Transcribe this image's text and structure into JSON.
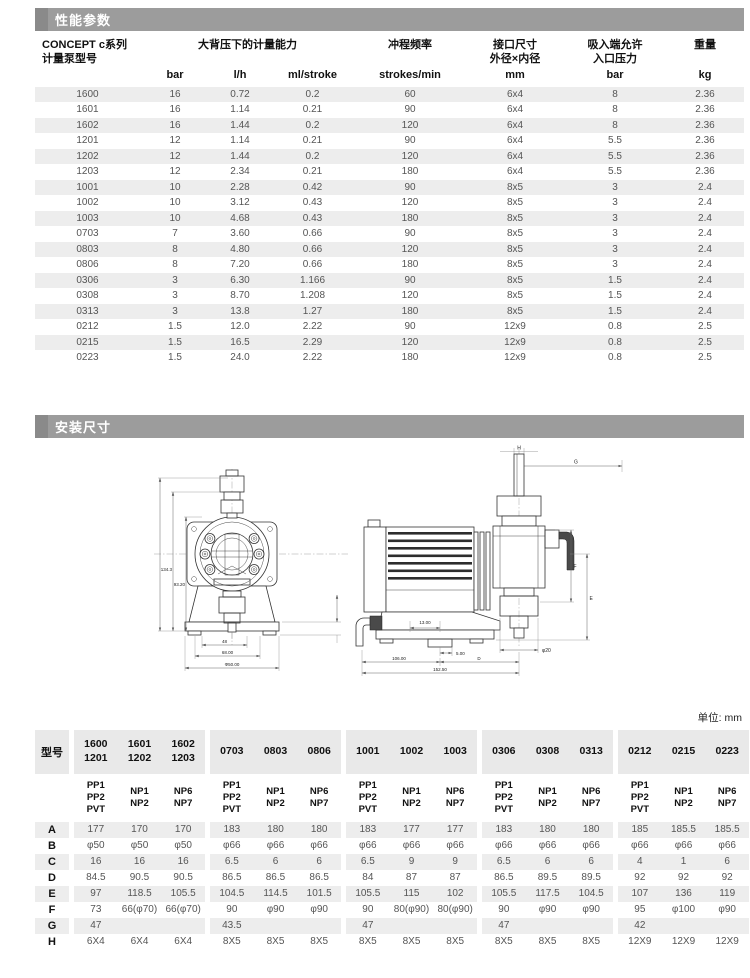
{
  "colors": {
    "section_bar": "#9c9c9c",
    "section_bar_chip": "#8a8a8a",
    "row_stripe": "#ededed",
    "header_text": "#111111",
    "body_text": "#555555"
  },
  "sections": {
    "performance": "性能参数",
    "installation": "安装尺寸"
  },
  "perf_table": {
    "group_headers": {
      "model": "CONCEPT c系列\n计量泵型号",
      "capacity": "大背压下的计量能力",
      "stroke_freq": "冲程频率",
      "connection": "接口尺寸\n外径×内径",
      "suction": "吸入端允许\n入口压力",
      "weight": "重量"
    },
    "units": [
      "bar",
      "l/h",
      "ml/stroke",
      "strokes/min",
      "mm",
      "bar",
      "kg"
    ],
    "rows": [
      [
        "1600",
        "16",
        "0.72",
        "0.2",
        "60",
        "6x4",
        "8",
        "2.36"
      ],
      [
        "1601",
        "16",
        "1.14",
        "0.21",
        "90",
        "6x4",
        "8",
        "2.36"
      ],
      [
        "1602",
        "16",
        "1.44",
        "0.2",
        "120",
        "6x4",
        "8",
        "2.36"
      ],
      [
        "1201",
        "12",
        "1.14",
        "0.21",
        "90",
        "6x4",
        "5.5",
        "2.36"
      ],
      [
        "1202",
        "12",
        "1.44",
        "0.2",
        "120",
        "6x4",
        "5.5",
        "2.36"
      ],
      [
        "1203",
        "12",
        "2.34",
        "0.21",
        "180",
        "6x4",
        "5.5",
        "2.36"
      ],
      [
        "1001",
        "10",
        "2.28",
        "0.42",
        "90",
        "8x5",
        "3",
        "2.4"
      ],
      [
        "1002",
        "10",
        "3.12",
        "0.43",
        "120",
        "8x5",
        "3",
        "2.4"
      ],
      [
        "1003",
        "10",
        "4.68",
        "0.43",
        "180",
        "8x5",
        "3",
        "2.4"
      ],
      [
        "0703",
        "7",
        "3.60",
        "0.66",
        "90",
        "8x5",
        "3",
        "2.4"
      ],
      [
        "0803",
        "8",
        "4.80",
        "0.66",
        "120",
        "8x5",
        "3",
        "2.4"
      ],
      [
        "0806",
        "8",
        "7.20",
        "0.66",
        "180",
        "8x5",
        "3",
        "2.4"
      ],
      [
        "0306",
        "3",
        "6.30",
        "1.166",
        "90",
        "8x5",
        "1.5",
        "2.4"
      ],
      [
        "0308",
        "3",
        "8.70",
        "1.208",
        "120",
        "8x5",
        "1.5",
        "2.4"
      ],
      [
        "0313",
        "3",
        "13.8",
        "1.27",
        "180",
        "8x5",
        "1.5",
        "2.4"
      ],
      [
        "0212",
        "1.5",
        "12.0",
        "2.22",
        "90",
        "12x9",
        "0.8",
        "2.5"
      ],
      [
        "0215",
        "1.5",
        "16.5",
        "2.29",
        "120",
        "12x9",
        "0.8",
        "2.5"
      ],
      [
        "0223",
        "1.5",
        "24.0",
        "2.22",
        "180",
        "12x9",
        "0.8",
        "2.5"
      ]
    ]
  },
  "drawings": {
    "front_dims": {
      "height_outer": "134.3",
      "height_inner": "93.20",
      "width_small": "48",
      "width_mid": "68.00",
      "width_full": "Φ50.00"
    },
    "side_dims": {
      "h": "H",
      "g": "G",
      "f": "F",
      "e": "E",
      "offset": "13.00",
      "foot": "5.00",
      "left_len": "106.00",
      "right_len": "D",
      "total_len": "152.50",
      "port": "φ20"
    }
  },
  "unit_note": "单位: mm",
  "dims_table": {
    "corner": "型号",
    "model_groups": [
      [
        "1600\n1201",
        "1601\n1202",
        "1602\n1203"
      ],
      [
        "0703",
        "0803",
        "0806"
      ],
      [
        "1001",
        "1002",
        "1003"
      ],
      [
        "0306",
        "0308",
        "0313"
      ],
      [
        "0212",
        "0215",
        "0223"
      ]
    ],
    "materials": [
      "PP1\nPP2\nPVT",
      "NP1\nNP2",
      "NP6\nNP7"
    ],
    "rows": [
      {
        "label": "A",
        "groups": [
          [
            "177",
            "170",
            "170"
          ],
          [
            "183",
            "180",
            "180"
          ],
          [
            "183",
            "177",
            "177"
          ],
          [
            "183",
            "180",
            "180"
          ],
          [
            "185",
            "185.5",
            "185.5"
          ]
        ]
      },
      {
        "label": "B",
        "groups": [
          [
            "φ50",
            "φ50",
            "φ50"
          ],
          [
            "φ66",
            "φ66",
            "φ66"
          ],
          [
            "φ66",
            "φ66",
            "φ66"
          ],
          [
            "φ66",
            "φ66",
            "φ66"
          ],
          [
            "φ66",
            "φ66",
            "φ66"
          ]
        ]
      },
      {
        "label": "C",
        "groups": [
          [
            "16",
            "16",
            "16"
          ],
          [
            "6.5",
            "6",
            "6"
          ],
          [
            "6.5",
            "9",
            "9"
          ],
          [
            "6.5",
            "6",
            "6"
          ],
          [
            "4",
            "1",
            "6"
          ]
        ]
      },
      {
        "label": "D",
        "groups": [
          [
            "84.5",
            "90.5",
            "90.5"
          ],
          [
            "86.5",
            "86.5",
            "86.5"
          ],
          [
            "84",
            "87",
            "87"
          ],
          [
            "86.5",
            "89.5",
            "89.5"
          ],
          [
            "92",
            "92",
            "92"
          ]
        ]
      },
      {
        "label": "E",
        "groups": [
          [
            "97",
            "118.5",
            "105.5"
          ],
          [
            "104.5",
            "114.5",
            "101.5"
          ],
          [
            "105.5",
            "115",
            "102"
          ],
          [
            "105.5",
            "117.5",
            "104.5"
          ],
          [
            "107",
            "136",
            "119"
          ]
        ]
      },
      {
        "label": "F",
        "groups": [
          [
            "73",
            "66(φ70)",
            "66(φ70)"
          ],
          [
            "90",
            "φ90",
            "φ90"
          ],
          [
            "90",
            "80(φ90)",
            "80(φ90)"
          ],
          [
            "90",
            "φ90",
            "φ90"
          ],
          [
            "95",
            "φ100",
            "φ90"
          ]
        ]
      },
      {
        "label": "G",
        "groups": [
          [
            "47",
            "",
            ""
          ],
          [
            "43.5",
            "",
            ""
          ],
          [
            "47",
            "",
            ""
          ],
          [
            "47",
            "",
            ""
          ],
          [
            "42",
            "",
            ""
          ]
        ]
      },
      {
        "label": "H",
        "groups": [
          [
            "6X4",
            "6X4",
            "6X4"
          ],
          [
            "8X5",
            "8X5",
            "8X5"
          ],
          [
            "8X5",
            "8X5",
            "8X5"
          ],
          [
            "8X5",
            "8X5",
            "8X5"
          ],
          [
            "12X9",
            "12X9",
            "12X9"
          ]
        ]
      }
    ]
  }
}
